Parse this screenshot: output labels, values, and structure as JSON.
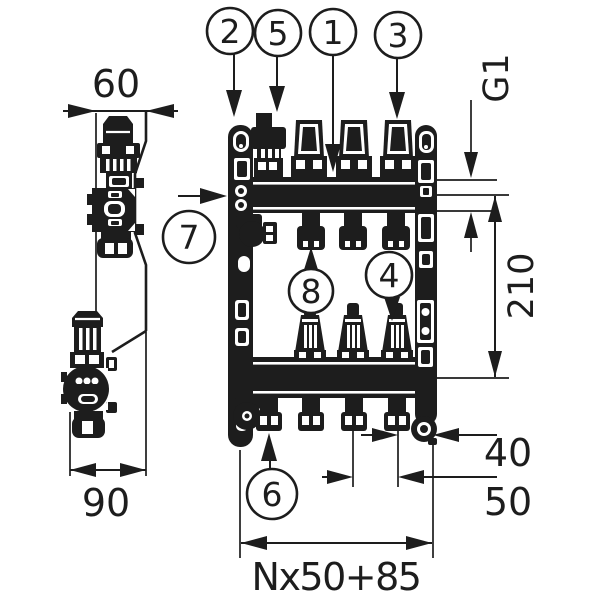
{
  "meta": {
    "description": "Technical dimensional line drawing of a floor-heating manifold (front view with mounting rails and side view) with numbered part callouts",
    "ink_color": "#1d1d1d",
    "background_color": "#ffffff"
  },
  "callouts": {
    "c1": "1",
    "c2": "2",
    "c3": "3",
    "c4": "4",
    "c5": "5",
    "c6": "6",
    "c7": "7",
    "c8": "8"
  },
  "dimensions": {
    "side_top_offset": "60",
    "side_depth": "90",
    "connection_thread": "G1",
    "bar_axis_spacing": "210",
    "end_pitch": "40",
    "outlet_pitch": "50",
    "total_length_formula": "Nx50+85"
  }
}
